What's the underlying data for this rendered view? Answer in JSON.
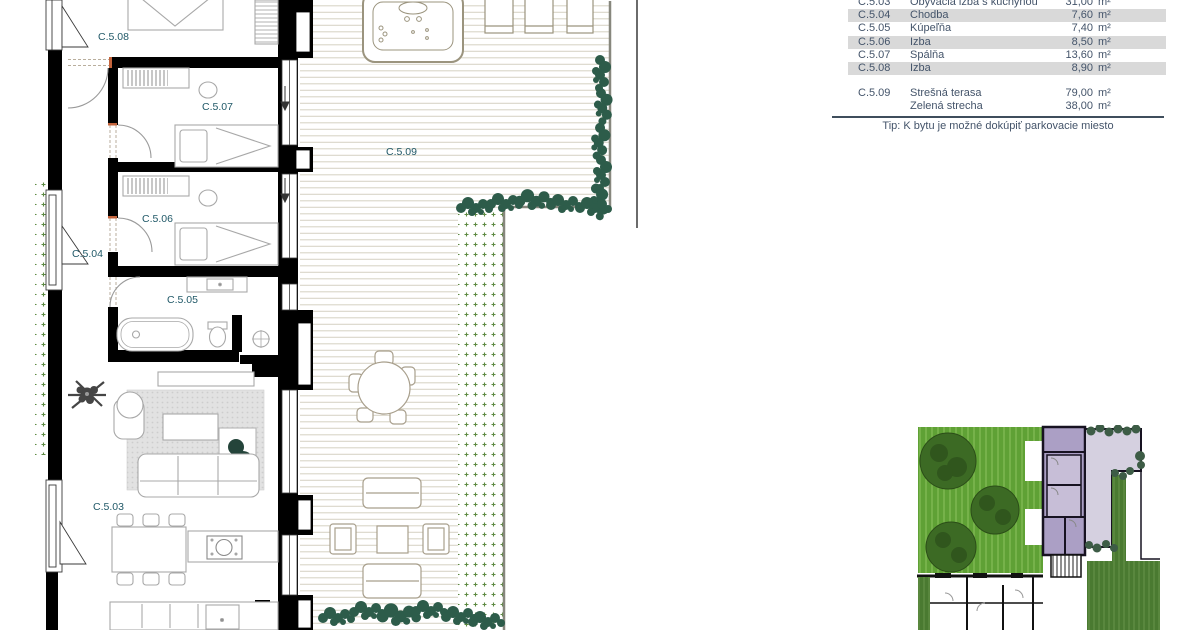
{
  "legend": {
    "rows": [
      {
        "code": "C.5.03",
        "name": "Obývacia izba s kuchyňou",
        "area": "31,00",
        "unit": "m²"
      },
      {
        "code": "C.5.04",
        "name": "Chodba",
        "area": "7,60",
        "unit": "m²"
      },
      {
        "code": "C.5.05",
        "name": "Kúpeľňa",
        "area": "7,40",
        "unit": "m²"
      },
      {
        "code": "C.5.06",
        "name": "Izba",
        "area": "8,50",
        "unit": "m²"
      },
      {
        "code": "C.5.07",
        "name": "Spálňa",
        "area": "13,60",
        "unit": "m²"
      },
      {
        "code": "C.5.08",
        "name": "Izba",
        "area": "8,90",
        "unit": "m²"
      }
    ],
    "roof": {
      "code": "C.5.09",
      "items": [
        {
          "name": "Strešná terasa",
          "area": "79,00",
          "unit": "m²"
        },
        {
          "name": "Zelená strecha",
          "area": "38,00",
          "unit": "m²"
        }
      ]
    },
    "tip_label": "Tip:",
    "tip_text": "K bytu je možné dokúpiť parkovacie miesto"
  },
  "colors": {
    "room_label": "#215968",
    "legend_text": "#44546a",
    "row_shade": "#d9d9d9",
    "plant_green": "#2d5c4a",
    "green_roof_dots": "#5d8a42",
    "deck_line": "#d9d5c7",
    "lawn_green": "#5fa135",
    "unit_highlight": "#ab9fc5",
    "terrace_lavender": "#d5d0e0"
  }
}
